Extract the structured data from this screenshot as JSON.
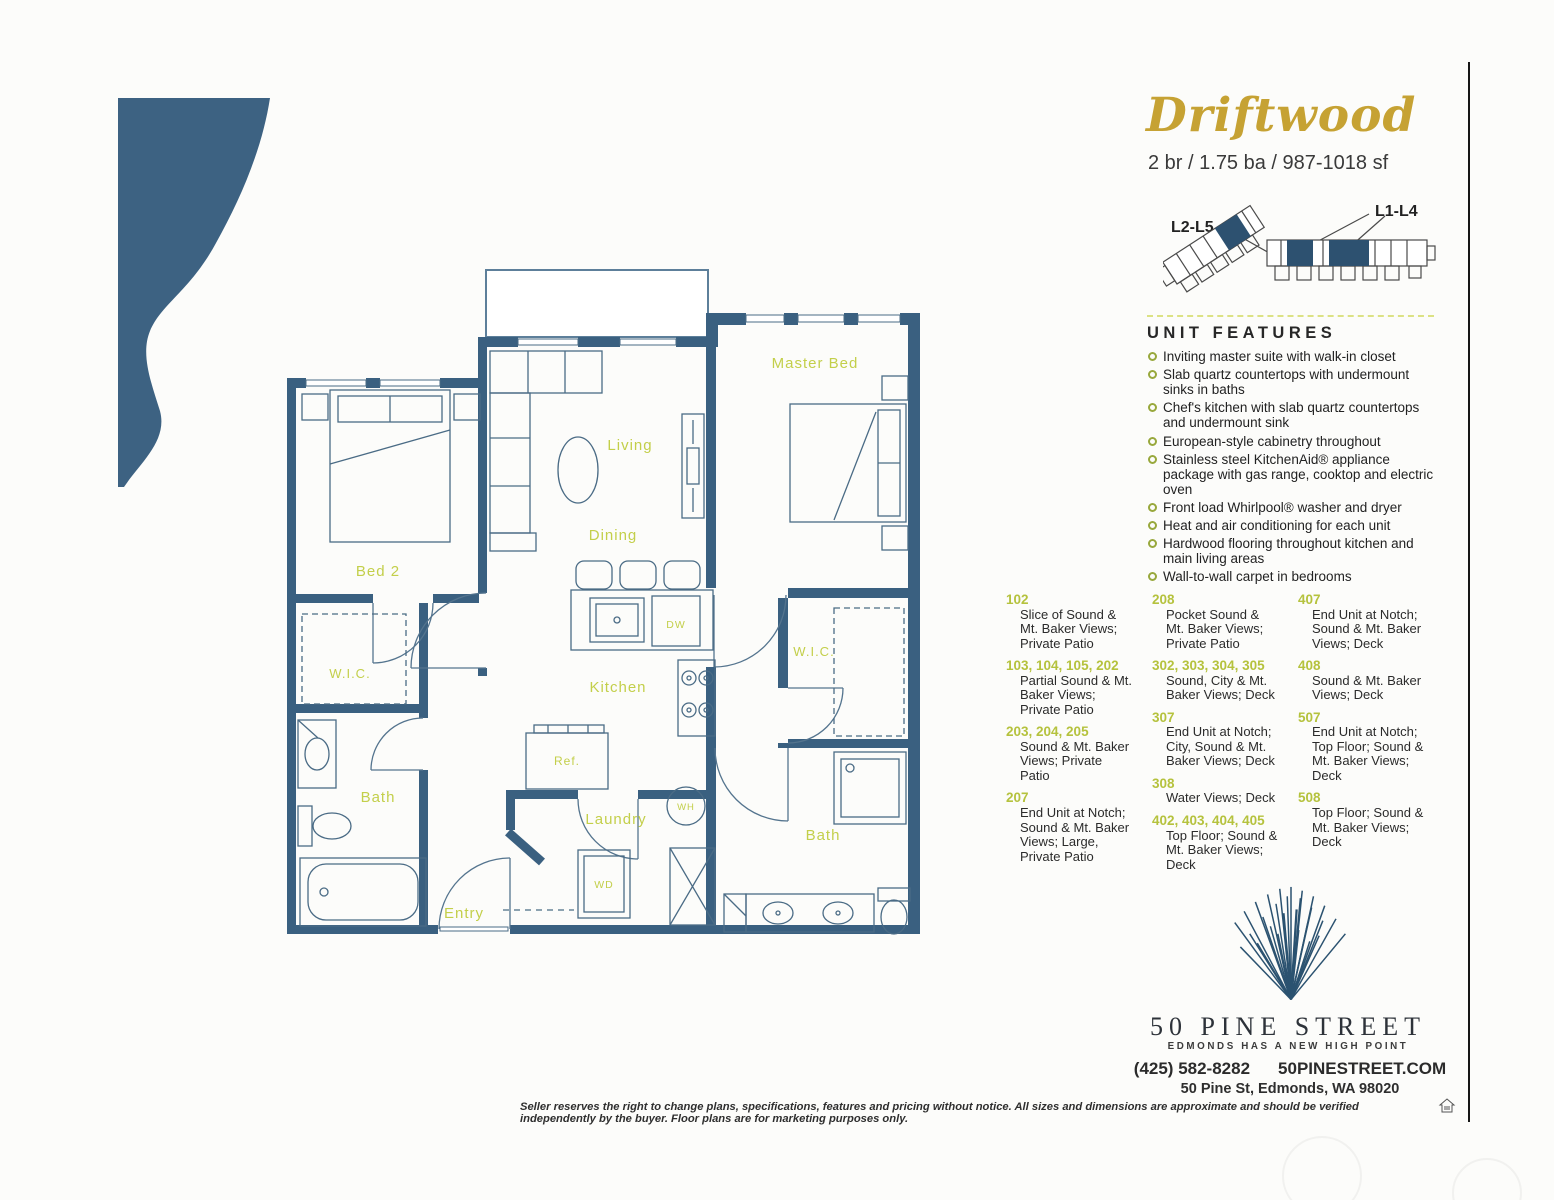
{
  "header": {
    "plan_name": "Driftwood",
    "specs": "2 br / 1.75 ba / 987-1018 sf"
  },
  "keyplan": {
    "left_label": "L2-L5",
    "right_label": "L1-L4"
  },
  "features": {
    "heading": "UNIT FEATURES",
    "items": [
      "Inviting master suite with walk-in closet",
      "Slab quartz countertops with undermount sinks in baths",
      "Chef's kitchen with slab quartz countertops and undermount sink",
      "European-style cabinetry throughout",
      "Stainless steel KitchenAid® appliance package with gas range, cooktop and electric oven",
      "Front load Whirlpool® washer and dryer",
      "Heat and air conditioning for each unit",
      "Hardwood flooring throughout kitchen and main living areas",
      "Wall-to-wall carpet in bedrooms"
    ]
  },
  "units": {
    "col1": [
      {
        "nums": "102",
        "desc": "Slice of Sound & Mt. Baker Views; Private Patio"
      },
      {
        "nums": "103, 104, 105, 202",
        "desc": "Partial Sound & Mt. Baker Views; Private Patio"
      },
      {
        "nums": "203, 204, 205",
        "desc": "Sound & Mt. Baker Views; Private Patio"
      },
      {
        "nums": "207",
        "desc": "End Unit at Notch; Sound & Mt. Baker Views; Large, Private Patio"
      }
    ],
    "col2": [
      {
        "nums": "208",
        "desc": "Pocket Sound & Mt. Baker Views; Private Patio"
      },
      {
        "nums": "302, 303, 304, 305",
        "desc": "Sound, City & Mt. Baker Views; Deck"
      },
      {
        "nums": "307",
        "desc": "End Unit at Notch; City, Sound & Mt. Baker Views; Deck"
      },
      {
        "nums": "308",
        "desc": "Water Views; Deck"
      },
      {
        "nums": "402, 403, 404, 405",
        "desc": "Top Floor; Sound & Mt. Baker Views; Deck"
      }
    ],
    "col3": [
      {
        "nums": "407",
        "desc": "End Unit at Notch; Sound & Mt. Baker Views; Deck"
      },
      {
        "nums": "408",
        "desc": "Sound & Mt. Baker Views; Deck"
      },
      {
        "nums": "507",
        "desc": "End Unit at Notch; Top Floor; Sound & Mt. Baker Views; Deck"
      },
      {
        "nums": "508",
        "desc": "Top Floor; Sound & Mt. Baker Views; Deck"
      }
    ]
  },
  "floorplan": {
    "labels": {
      "living": "Living",
      "dining": "Dining",
      "kitchen": "Kitchen",
      "master_bed": "Master Bed",
      "bed2": "Bed 2",
      "wic_left": "W.I.C.",
      "wic_right": "W.I.C.",
      "bath_left": "Bath",
      "bath_right": "Bath",
      "laundry": "Laundry",
      "entry": "Entry",
      "dw": "DW",
      "ref": "Ref.",
      "wh": "WH",
      "wd": "WD"
    }
  },
  "branding": {
    "logo_name": "50 PINE STREET",
    "tagline": "EDMONDS HAS A NEW HIGH POINT",
    "phone": "(425) 582-8282",
    "website": "50PINESTREET.COM",
    "address": "50 Pine St, Edmonds, WA 98020"
  },
  "disclaimer": "Seller reserves the right to change plans, specifications, features and pricing without notice. All sizes and dimensions are approximate and should be verified independently by the buyer.  Floor plans are for marketing purposes only.",
  "colors": {
    "wall_blue": "#3a6080",
    "label_green": "#c3cf4a",
    "gold": "#c6a233",
    "navy": "#2d5170"
  }
}
